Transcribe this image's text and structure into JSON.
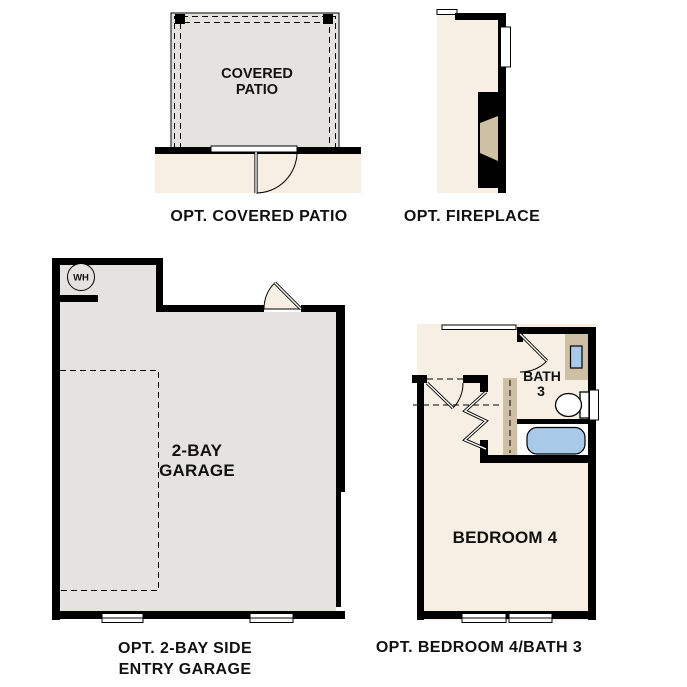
{
  "colors": {
    "background": "#ffffff",
    "wall": "#000000",
    "floor_gray": "#e4e3e0",
    "floor_cream": "#f7efe3",
    "cabinet_tan": "#cdc0a4",
    "fixture_blue": "#a9c9e9",
    "text": "#111111"
  },
  "plans": {
    "covered_patio": {
      "room_label": [
        "COVERED",
        "PATIO"
      ],
      "caption": "OPT. COVERED PATIO"
    },
    "fireplace": {
      "caption": "OPT. FIREPLACE"
    },
    "garage": {
      "room_label": [
        "2-BAY",
        "GARAGE"
      ],
      "water_heater": "WH",
      "caption": [
        "OPT. 2-BAY SIDE",
        "ENTRY GARAGE"
      ]
    },
    "bedroom_bath": {
      "bedroom_label": "BEDROOM 4",
      "bath_label": [
        "BATH",
        "3"
      ],
      "caption": "OPT. BEDROOM 4/BATH 3"
    }
  }
}
